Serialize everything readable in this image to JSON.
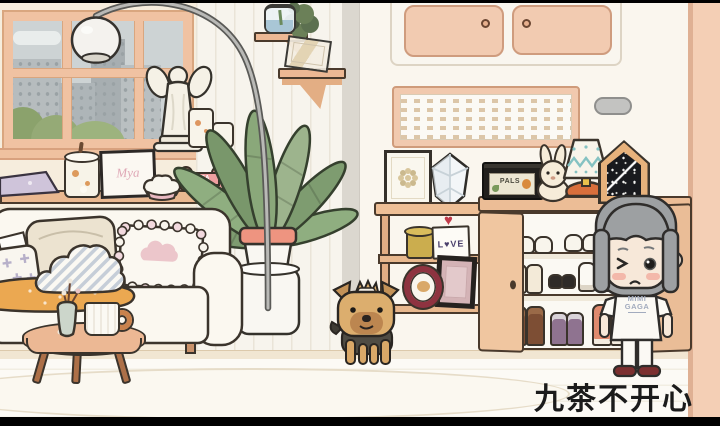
{
  "scene": {
    "caption": "九茶不开心",
    "icons": {
      "heart": "♥"
    },
    "labels": {
      "shirt_line1": "MIMI",
      "shirt_line2": "GAGA",
      "pals_box": "PALS",
      "bone": "MIGA",
      "love_card": "L♥VE",
      "frame_art": "Mya"
    },
    "colors": {
      "wall_cream": "#f8f3ea",
      "wall_salmon": "#f4cfb5",
      "wood_peach": "#ecb894",
      "sofa_white": "#fbf8f0",
      "blanket_mustard": "#eba851",
      "leaf_green": "#8aa87a",
      "hair_gray": "#9da0a2",
      "shoe_maroon": "#7c3030",
      "outline_dark": "#3b342c"
    }
  }
}
